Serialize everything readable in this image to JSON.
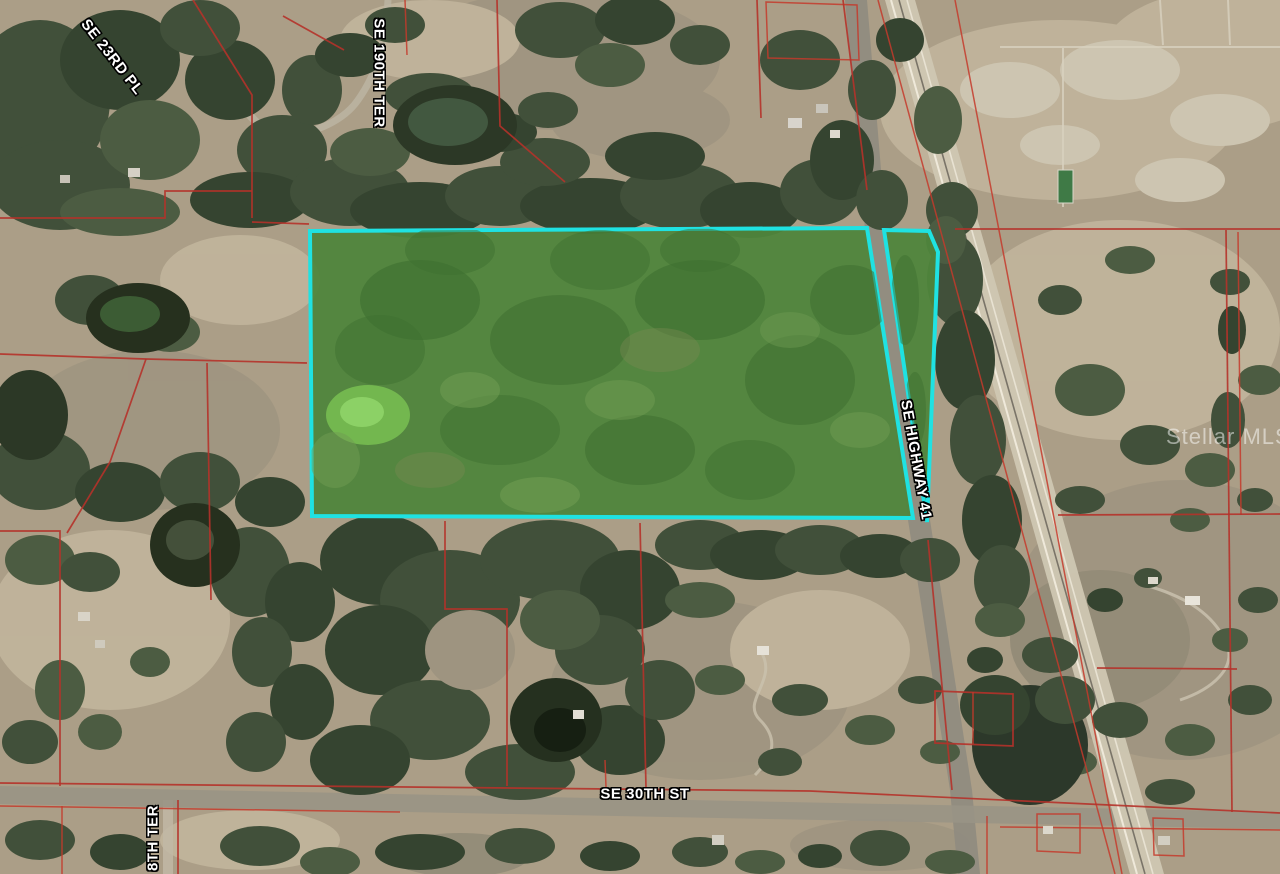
{
  "map": {
    "description": "Aerial property map with parcel boundaries and highlighted listing parcel",
    "watermark": "Stellar MLS",
    "labels": {
      "se_23rd_pl": "SE 23RD PL",
      "se_190th_ter": "SE 190TH TER",
      "se_highway_41": "SE HIGHWAY 41",
      "se_30th_st": "SE 30TH ST",
      "se_188th_ter": "8TH TER"
    },
    "highlight": {
      "outline_color": "#1fe2e2",
      "fill_color": "#4f853c",
      "main_parcel_points": "310,231 867,228 913,518 312,516",
      "strip_parcel_points": "884,230 929,231 938,252 927,522"
    },
    "parcel_line_color": "#b5322a"
  }
}
